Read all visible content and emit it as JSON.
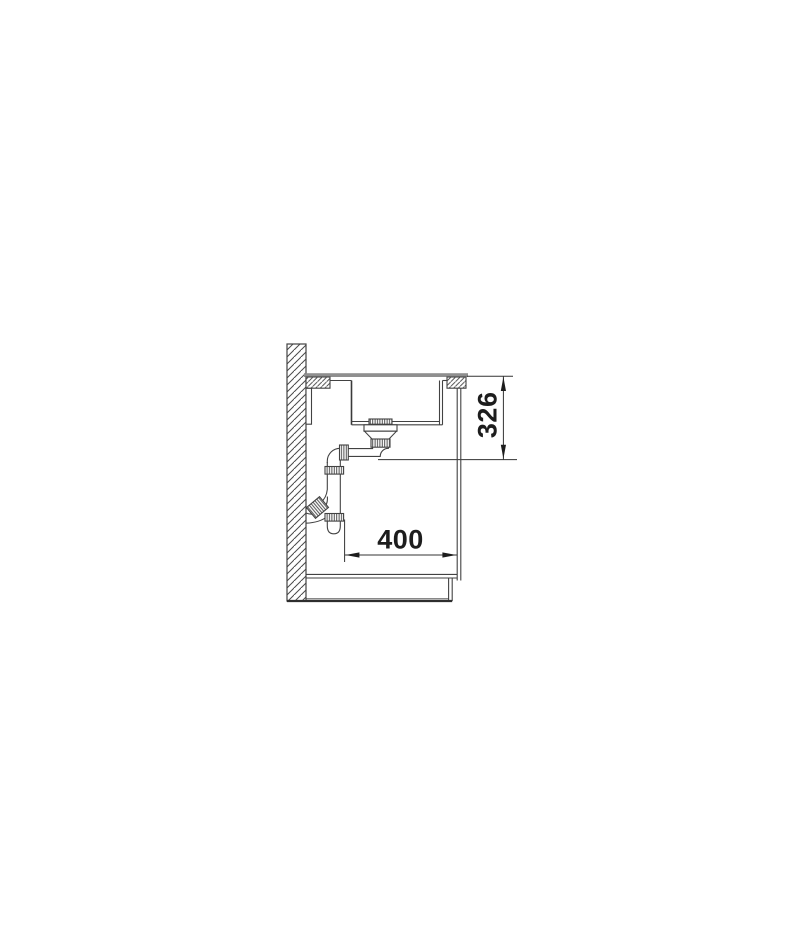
{
  "page": {
    "background_color": "#ffffff"
  },
  "drawing": {
    "line_color": "#424242",
    "worktop_surface_color": "#8f8f8f",
    "dimension_text_color": "#1d1d1d",
    "dimensions": {
      "vertical": {
        "label": "326"
      },
      "horizontal": {
        "label": "400"
      }
    }
  }
}
